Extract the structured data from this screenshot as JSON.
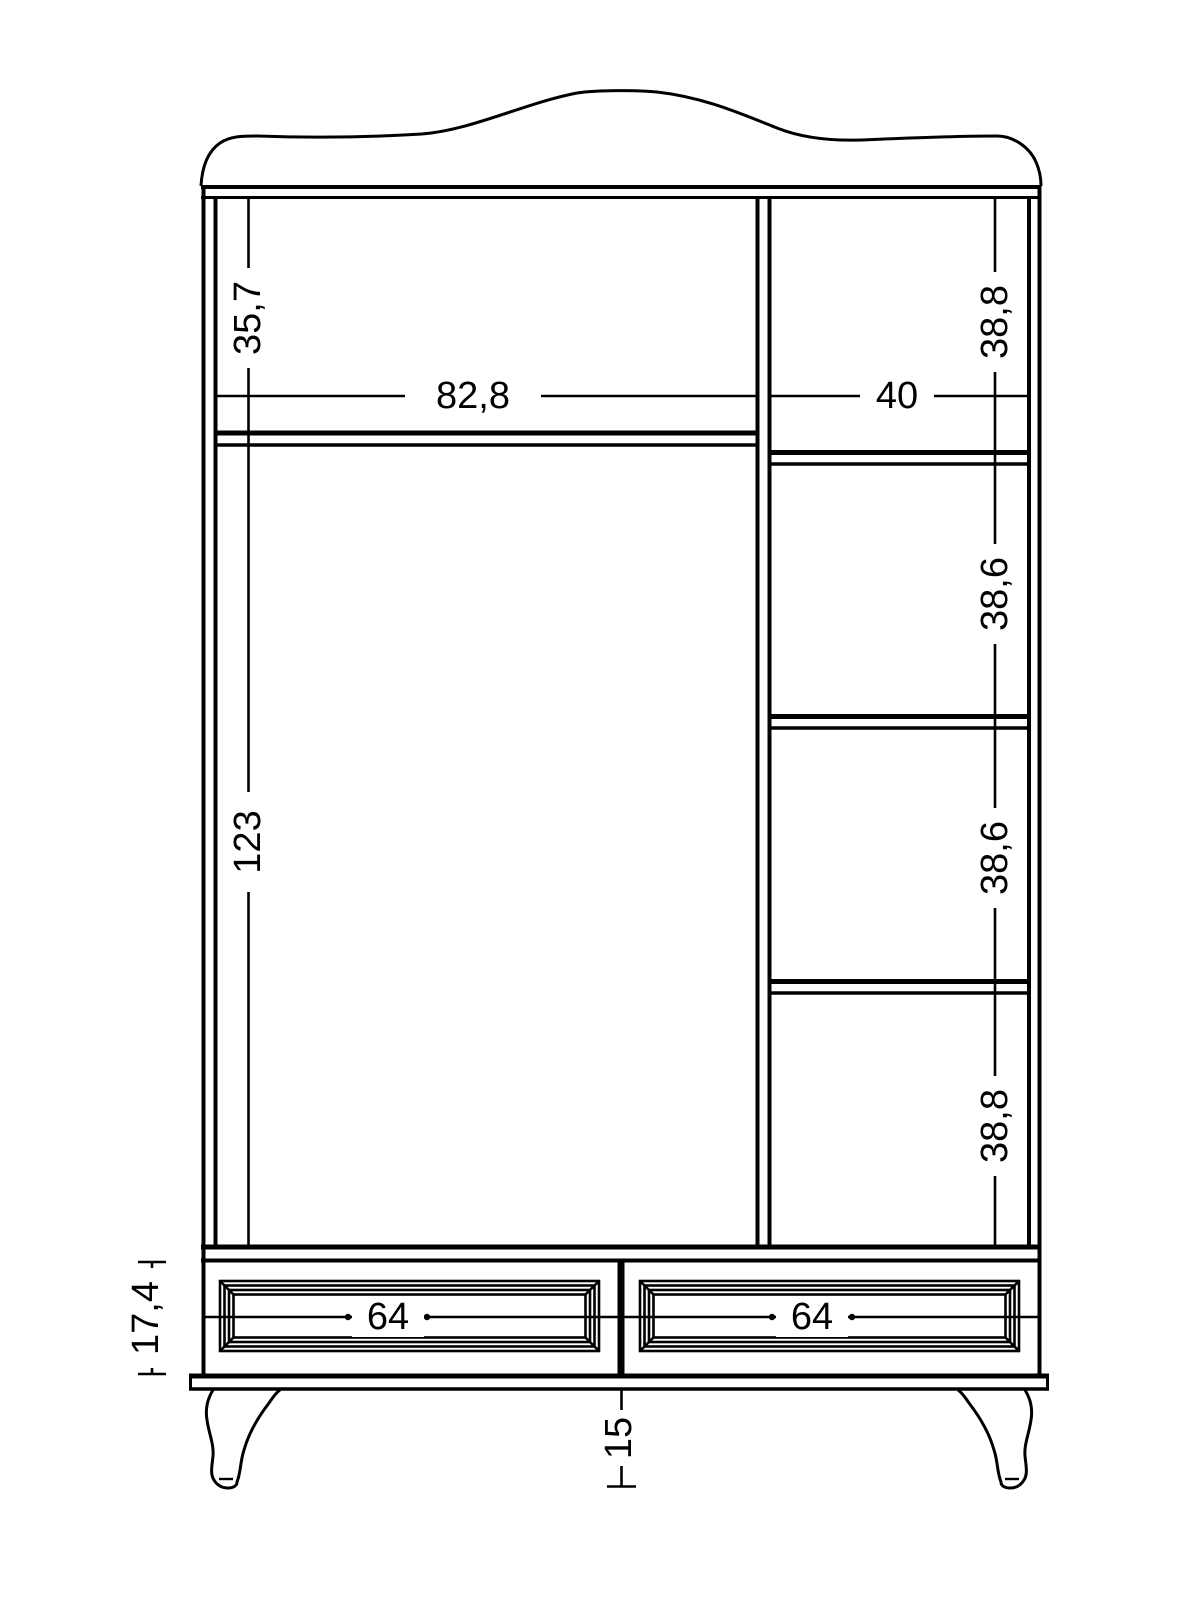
{
  "colors": {
    "background": "#ffffff",
    "line": "#000000"
  },
  "dims": {
    "left_top_height": "35,7",
    "left_opening_width": "82,8",
    "left_main_height": "123",
    "right_opening_width": "40",
    "right_compartment_1": "38,8",
    "right_compartment_2": "38,6",
    "right_compartment_3": "38,6",
    "right_compartment_4": "38,8",
    "drawer_left_width": "64",
    "drawer_right_width": "64",
    "drawer_section_height": "17,4",
    "leg_height": "15"
  }
}
